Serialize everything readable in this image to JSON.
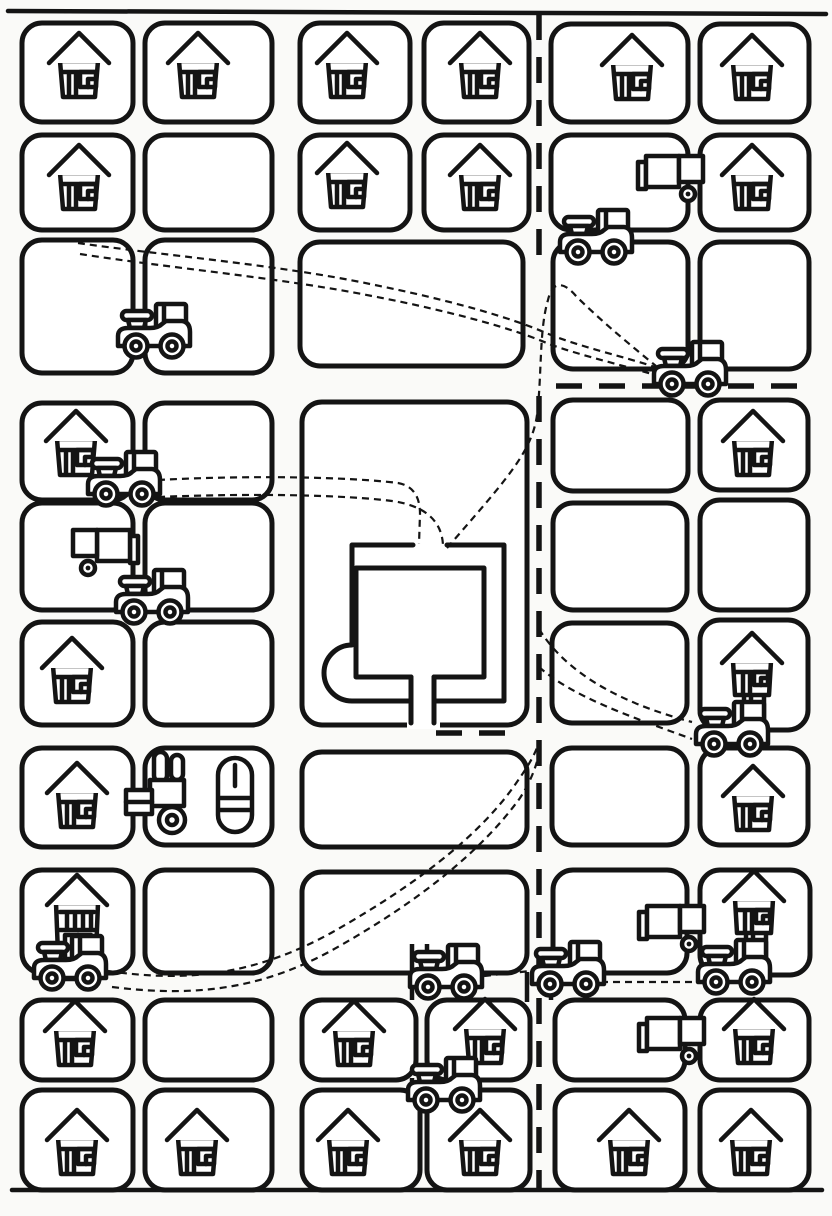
{
  "meta": {
    "alt": "Black-and-white coloring-page style town map: rounded city blocks with houses, tractors, trucks, a forklift and a central walled plaza, connected by dashed roads and dotted routes"
  },
  "palette": {
    "ink": "#141414",
    "paper": "#fafaf8",
    "fill": "#ffffff"
  },
  "canvas": {
    "width": 832,
    "height": 1216
  },
  "borders": [
    {
      "name": "top-border",
      "d": "M8,11 L826,14"
    },
    {
      "name": "bottom-border",
      "d": "M12,1190 H822"
    }
  ],
  "blocks": [
    {
      "x": 22,
      "y": 23,
      "w": 111,
      "h": 99
    },
    {
      "x": 145,
      "y": 23,
      "w": 127,
      "h": 99
    },
    {
      "x": 300,
      "y": 23,
      "w": 110,
      "h": 99
    },
    {
      "x": 424,
      "y": 23,
      "w": 105,
      "h": 99
    },
    {
      "x": 551,
      "y": 24,
      "w": 137,
      "h": 98
    },
    {
      "x": 700,
      "y": 24,
      "w": 109,
      "h": 98
    },
    {
      "x": 22,
      "y": 135,
      "w": 111,
      "h": 95
    },
    {
      "x": 145,
      "y": 135,
      "w": 127,
      "h": 95
    },
    {
      "x": 300,
      "y": 135,
      "w": 110,
      "h": 95
    },
    {
      "x": 424,
      "y": 135,
      "w": 105,
      "h": 95
    },
    {
      "x": 551,
      "y": 135,
      "w": 137,
      "h": 95
    },
    {
      "x": 700,
      "y": 135,
      "w": 109,
      "h": 95
    },
    {
      "x": 22,
      "y": 240,
      "w": 111,
      "h": 133
    },
    {
      "x": 145,
      "y": 240,
      "w": 127,
      "h": 133
    },
    {
      "x": 300,
      "y": 242,
      "w": 223,
      "h": 124
    },
    {
      "x": 553,
      "y": 242,
      "w": 135,
      "h": 127
    },
    {
      "x": 700,
      "y": 242,
      "w": 109,
      "h": 127
    },
    {
      "x": 302,
      "y": 402,
      "w": 225,
      "h": 323
    },
    {
      "x": 22,
      "y": 403,
      "w": 111,
      "h": 97
    },
    {
      "x": 145,
      "y": 403,
      "w": 127,
      "h": 97
    },
    {
      "x": 553,
      "y": 400,
      "w": 135,
      "h": 91
    },
    {
      "x": 700,
      "y": 400,
      "w": 108,
      "h": 90
    },
    {
      "x": 22,
      "y": 503,
      "w": 111,
      "h": 107
    },
    {
      "x": 145,
      "y": 503,
      "w": 127,
      "h": 107
    },
    {
      "x": 553,
      "y": 503,
      "w": 134,
      "h": 107
    },
    {
      "x": 700,
      "y": 500,
      "w": 108,
      "h": 110
    },
    {
      "x": 22,
      "y": 622,
      "w": 111,
      "h": 103
    },
    {
      "x": 145,
      "y": 622,
      "w": 127,
      "h": 103
    },
    {
      "x": 552,
      "y": 623,
      "w": 135,
      "h": 100
    },
    {
      "x": 700,
      "y": 620,
      "w": 108,
      "h": 110
    },
    {
      "x": 22,
      "y": 748,
      "w": 111,
      "h": 99
    },
    {
      "x": 145,
      "y": 748,
      "w": 127,
      "h": 97
    },
    {
      "x": 302,
      "y": 752,
      "w": 225,
      "h": 95
    },
    {
      "x": 552,
      "y": 748,
      "w": 135,
      "h": 97
    },
    {
      "x": 700,
      "y": 748,
      "w": 108,
      "h": 97
    },
    {
      "x": 22,
      "y": 870,
      "w": 111,
      "h": 103
    },
    {
      "x": 145,
      "y": 870,
      "w": 127,
      "h": 103
    },
    {
      "x": 302,
      "y": 872,
      "w": 225,
      "h": 101
    },
    {
      "x": 553,
      "y": 870,
      "w": 134,
      "h": 103
    },
    {
      "x": 700,
      "y": 870,
      "w": 110,
      "h": 105
    },
    {
      "x": 22,
      "y": 1000,
      "w": 111,
      "h": 80
    },
    {
      "x": 145,
      "y": 1000,
      "w": 127,
      "h": 80
    },
    {
      "x": 302,
      "y": 1000,
      "w": 114,
      "h": 80
    },
    {
      "x": 427,
      "y": 1000,
      "w": 103,
      "h": 80
    },
    {
      "x": 555,
      "y": 1000,
      "w": 130,
      "h": 80
    },
    {
      "x": 700,
      "y": 1000,
      "w": 109,
      "h": 80
    },
    {
      "x": 22,
      "y": 1090,
      "w": 111,
      "h": 100
    },
    {
      "x": 145,
      "y": 1090,
      "w": 127,
      "h": 100
    },
    {
      "x": 302,
      "y": 1090,
      "w": 118,
      "h": 100
    },
    {
      "x": 427,
      "y": 1090,
      "w": 103,
      "h": 100
    },
    {
      "x": 555,
      "y": 1090,
      "w": 130,
      "h": 100
    },
    {
      "x": 700,
      "y": 1090,
      "w": 109,
      "h": 100
    }
  ],
  "street_connectors": [
    {
      "d": "M412,944 V1000"
    },
    {
      "d": "M427,944 V1000"
    },
    {
      "d": "M412,1078 V1092"
    },
    {
      "d": "M427,1078 V1092"
    },
    {
      "d": "M527,972 V1002"
    },
    {
      "d": "M551,972 V1000"
    }
  ],
  "central_structure": {
    "gap_rect": {
      "x": 407,
      "y": 719,
      "w": 33,
      "h": 10
    },
    "outer": "M413,545 H352 V645 A28 28 0 0 0 352,701 H411 M434,701 H504 V545 H447",
    "inner": "M411,677 H356 V568 H484 V677 H434",
    "chute": "M411,677 V723 M434,677 V723"
  },
  "bold_roads": [
    {
      "name": "vertical-road-upper",
      "d": "M539,14 V262"
    },
    {
      "name": "vertical-road-lower",
      "d": "M539,396 V1188"
    },
    {
      "name": "east-road",
      "d": "M556,386 H806"
    },
    {
      "name": "plaza-road",
      "d": "M436,733 H512"
    }
  ],
  "routes": [
    {
      "name": "route-nw-to-east-a",
      "d": "M78,243 C160,255 280,265 370,284 C450,300 512,318 546,333 C580,347 626,357 658,368"
    },
    {
      "name": "route-nw-to-east-b",
      "d": "M80,254 C170,268 282,278 372,296 C455,312 517,330 549,344 C582,356 630,367 662,377"
    },
    {
      "name": "route-west-to-plaza-a",
      "d": "M158,480 C250,475 350,477 398,483 Q420,487 420,514 L419,544"
    },
    {
      "name": "route-west-to-plaza-b",
      "d": "M158,497 C255,493 345,495 392,501 Q441,508 443,545"
    },
    {
      "name": "route-plaza-to-east",
      "d": "M447,548 C506,480 532,452 537,415 C542,375 539,330 548,300 C553,278 566,284 576,296 C602,322 634,348 656,366"
    },
    {
      "name": "route-sw-sweep-a",
      "d": "M108,971 C190,983 256,974 331,933 C400,894 470,846 512,789 C527,768 536,754 539,741"
    },
    {
      "name": "route-sw-sweep-b",
      "d": "M112,987 C200,998 268,988 343,944 C411,905 478,856 520,798 C531,781 537,765 540,749"
    },
    {
      "name": "route-road-to-se-a",
      "d": "M539,629 C565,671 616,702 692,722"
    },
    {
      "name": "route-road-to-se-b",
      "d": "M539,667 C573,697 629,716 692,739"
    },
    {
      "name": "route-cluster-link-1",
      "d": "M484,976 L530,971"
    },
    {
      "name": "route-cluster-link-2",
      "d": "M601,982 H692"
    }
  ],
  "houses": [
    {
      "type": "house",
      "x": 47,
      "y": 30
    },
    {
      "type": "house",
      "x": 166,
      "y": 30
    },
    {
      "type": "house",
      "x": 315,
      "y": 30
    },
    {
      "type": "house",
      "x": 448,
      "y": 30
    },
    {
      "type": "house",
      "x": 600,
      "y": 32
    },
    {
      "type": "house",
      "x": 720,
      "y": 32
    },
    {
      "type": "house",
      "x": 47,
      "y": 142
    },
    {
      "type": "house",
      "x": 315,
      "y": 140
    },
    {
      "type": "house",
      "x": 448,
      "y": 142
    },
    {
      "type": "house",
      "x": 720,
      "y": 142
    },
    {
      "type": "house",
      "x": 44,
      "y": 408
    },
    {
      "type": "house",
      "x": 721,
      "y": 408
    },
    {
      "type": "house",
      "x": 40,
      "y": 635
    },
    {
      "type": "house",
      "x": 45,
      "y": 760
    },
    {
      "type": "house",
      "x": 721,
      "y": 763
    },
    {
      "type": "house_tall",
      "x": 46,
      "y": 872
    },
    {
      "type": "house_stilt",
      "x": 720,
      "y": 630
    },
    {
      "type": "house_stilt",
      "x": 722,
      "y": 868
    },
    {
      "type": "house",
      "x": 43,
      "y": 998
    },
    {
      "type": "house",
      "x": 322,
      "y": 998
    },
    {
      "type": "house",
      "x": 453,
      "y": 996
    },
    {
      "type": "house",
      "x": 722,
      "y": 996
    },
    {
      "type": "house",
      "x": 45,
      "y": 1107
    },
    {
      "type": "house",
      "x": 165,
      "y": 1107
    },
    {
      "type": "house",
      "x": 316,
      "y": 1107
    },
    {
      "type": "house",
      "x": 448,
      "y": 1107
    },
    {
      "type": "house",
      "x": 597,
      "y": 1107
    },
    {
      "type": "house",
      "x": 719,
      "y": 1107
    }
  ],
  "vehicles": [
    {
      "type": "tractor",
      "x": 556,
      "y": 208
    },
    {
      "type": "tractor",
      "x": 650,
      "y": 340
    },
    {
      "type": "tractor",
      "x": 114,
      "y": 302
    },
    {
      "type": "tractor",
      "x": 84,
      "y": 450
    },
    {
      "type": "tractor",
      "x": 112,
      "y": 568
    },
    {
      "type": "tractor",
      "x": 692,
      "y": 700
    },
    {
      "type": "tractor",
      "x": 30,
      "y": 934
    },
    {
      "type": "tractor",
      "x": 406,
      "y": 943
    },
    {
      "type": "tractor",
      "x": 528,
      "y": 940
    },
    {
      "type": "tractor",
      "x": 694,
      "y": 938
    },
    {
      "type": "tractor",
      "x": 404,
      "y": 1056
    },
    {
      "type": "truck",
      "x": 636,
      "y": 152
    },
    {
      "type": "truck",
      "x": 70,
      "y": 526,
      "flip": true
    },
    {
      "type": "truck",
      "x": 637,
      "y": 902
    },
    {
      "type": "truck",
      "x": 637,
      "y": 1014
    },
    {
      "type": "forklift",
      "x": 124,
      "y": 750
    },
    {
      "type": "capsule",
      "x": 216,
      "y": 756
    }
  ]
}
